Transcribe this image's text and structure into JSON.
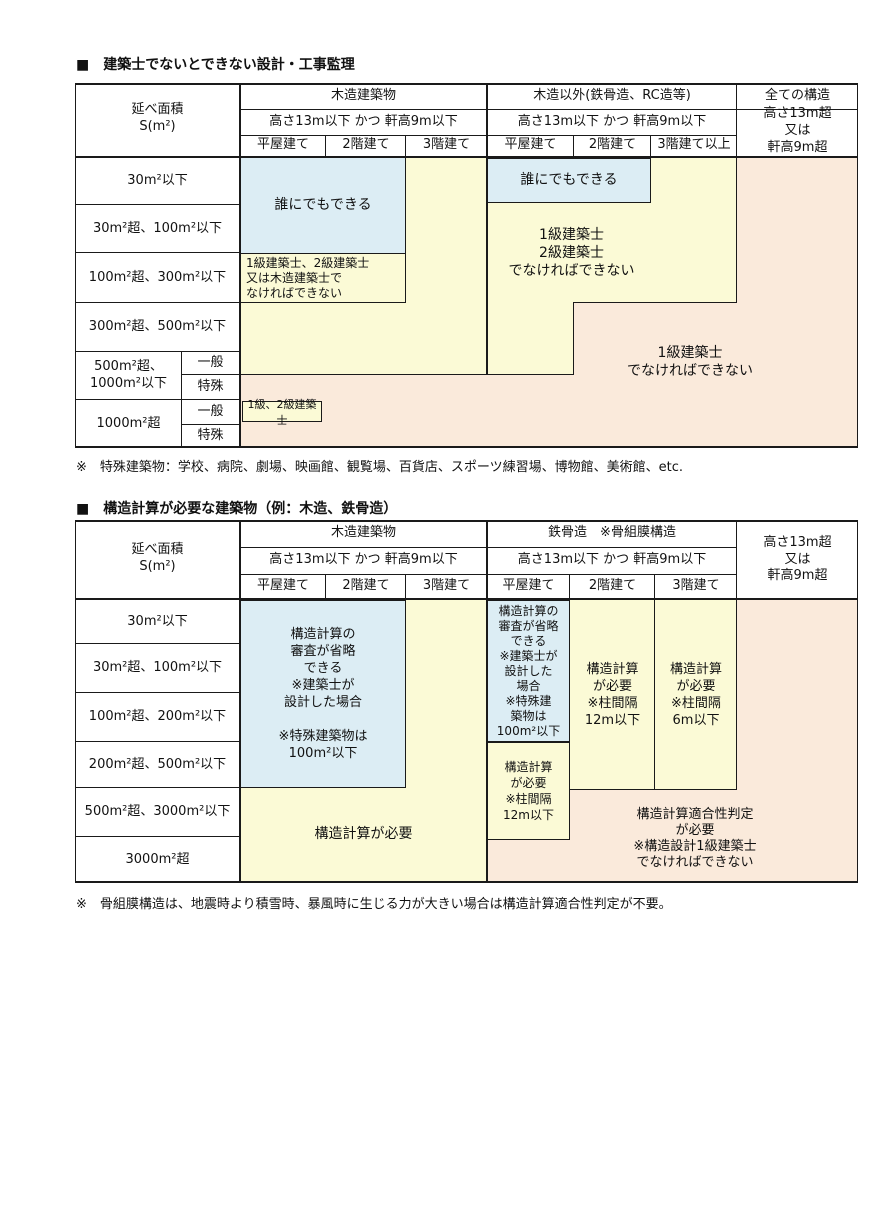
{
  "colors": {
    "blue": "#dcedf4",
    "yellow": "#fbfad6",
    "peach": "#faeadb",
    "border": "#1a1a1a"
  },
  "table1": {
    "title": "■　建築士でないとできない設計・工事監理",
    "header": {
      "area": "延べ面積\nS(m²)",
      "wood_group": "木造建築物",
      "nonwood_group": "木造以外(鉄骨造、RC造等)",
      "all_group": "全ての構造",
      "cond": "高さ13m以下 かつ 軒高9m以下",
      "over": "高さ13m超\n又は\n軒高9m超",
      "wood_cols": [
        "平屋建て",
        "2階建て",
        "3階建て"
      ],
      "nonwood_cols": [
        "平屋建て",
        "2階建て",
        "3階建て以上"
      ]
    },
    "rows": [
      "30m²以下",
      "30m²超、100m²以下",
      "100m²超、300m²以下",
      "300m²超、500m²以下",
      "500m²超、\n1000m²以下",
      "1000m²超"
    ],
    "sub": {
      "general": "一般",
      "special": "特殊"
    },
    "cells": {
      "anyone": "誰にでもできる",
      "anyone2": "誰にでもできる",
      "lv12_wood": "1級建築士、2級建築士\n又は木造建築士で\nなければできない",
      "lv12": "1級建築士\n2級建築士\nでなければできない",
      "lv1": "1級建築士\nでなければできない",
      "lv12_small": "1級、2級建築士"
    },
    "footnote": "※　特殊建築物：学校、病院、劇場、映画館、観覧場、百貨店、スポーツ練習場、博物館、美術館、etc."
  },
  "table2": {
    "title": "■　構造計算が必要な建築物（例：木造、鉄骨造）",
    "header": {
      "area": "延べ面積\nS(m²)",
      "wood_group": "木造建築物",
      "steel_group": "鉄骨造　※骨組膜構造",
      "cond": "高さ13m以下 かつ 軒高9m以下",
      "over": "高さ13m超\n又は\n軒高9m超",
      "wood_cols": [
        "平屋建て",
        "2階建て",
        "3階建て"
      ],
      "steel_cols": [
        "平屋建て",
        "2階建て",
        "3階建て"
      ]
    },
    "rows": [
      "30m²以下",
      "30m²超、100m²以下",
      "100m²超、200m²以下",
      "200m²超、500m²以下",
      "500m²超、3000m²以下",
      "3000m²超"
    ],
    "cells": {
      "wood_skip": "構造計算の\n審査が省略\nできる\n※建築士が\n設計した場合\n\n※特殊建築物は\n100m²以下",
      "steel_skip": "構造計算の\n審査が省略\nできる\n※建築士が\n設計した\n場合\n※特殊建\n築物は\n100m²以下",
      "steel_req_12a": "構造計算\nが必要\n※柱間隔\n12m以下",
      "steel_req_12b": "構造計算\nが必要\n※柱間隔\n12m以下",
      "steel_req_6": "構造計算\nが必要\n※柱間隔\n6m以下",
      "wood_req": "構造計算が必要",
      "judge": "構造計算適合性判定\nが必要\n※構造設計1級建築士\nでなければできない"
    },
    "footnote": "※　骨組膜構造は、地震時より積雪時、暴風時に生じる力が大きい場合は構造計算適合性判定が不要。"
  }
}
